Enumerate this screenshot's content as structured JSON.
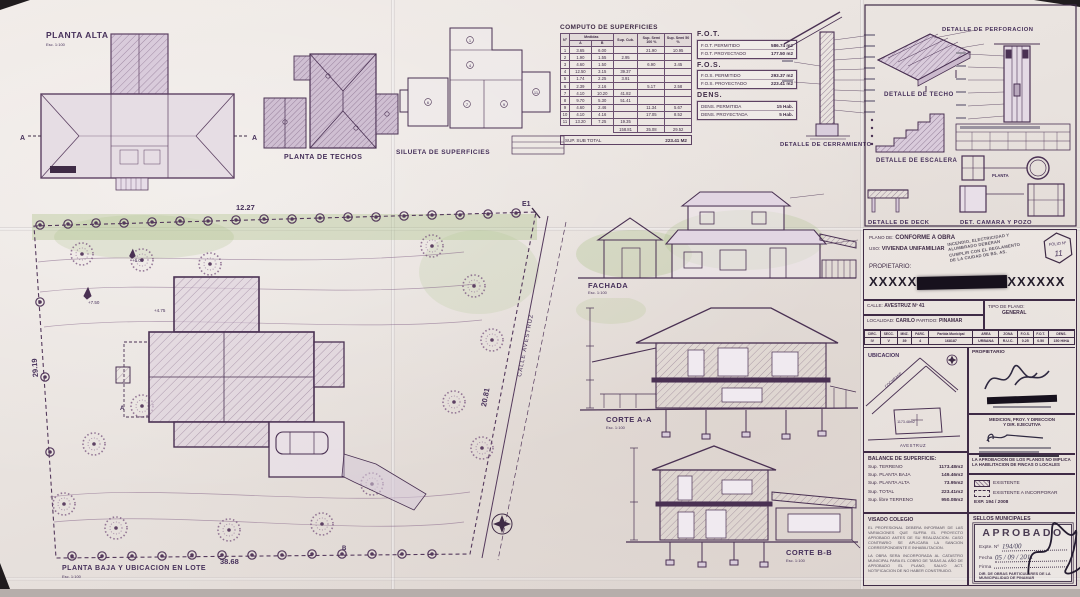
{
  "captions": {
    "planta_alta": "PLANTA ALTA",
    "planta_techos": "PLANTA DE TECHOS",
    "silueta": "SILUETA DE SUPERFICIES",
    "fachada": "FACHADA",
    "corte_aa": "CORTE A-A",
    "corte_bb": "CORTE B-B",
    "planta_baja": "PLANTA BAJA Y UBICACION EN LOTE",
    "det_cerramiento": "DETALLE DE CERRAMIENTO",
    "det_techo": "DETALLE DE TECHO",
    "det_perforacion": "DETALLE DE PERFORACION",
    "det_escalera": "DETALLE DE ESCALERA",
    "det_deck": "DETALLE DE DECK",
    "det_camara": "DET. CAMARA Y POZO",
    "planta_small": "PLANTA",
    "scale_100": "Esc. 1:100",
    "scale_200": "Esc. 1:200"
  },
  "site": {
    "dim_top": "12.27",
    "dim_left": "29.19",
    "dim_right": "20.81",
    "dim_bottom": "38.68",
    "street": "CALLE  AVESTRUZ",
    "marker_e1": "E1",
    "marker_a": "A",
    "marker_b": "B",
    "contour_1": "+6.00",
    "contour_2": "+7.50",
    "contour_3": "+4.75"
  },
  "silueta_tags": [
    "1",
    "4",
    "6",
    "7",
    "9",
    "11"
  ],
  "computo": {
    "title": "COMPUTO DE SUPERFICIES",
    "col_n": "Nº",
    "col_medidas": "Medidas",
    "col_a": "A",
    "col_b": "B",
    "col_cub": "Sup. Cub.",
    "col_semi100": "Sup. Semi 100 %",
    "col_semi50": "Sup. Semi 50 %",
    "rows": [
      [
        "1",
        "3.65",
        "6.00",
        "",
        "21.90",
        "10.95"
      ],
      [
        "2",
        "1.90",
        "1.55",
        "2.95",
        "",
        ""
      ],
      [
        "3",
        "4.60",
        "1.50",
        "",
        "6.90",
        "3.45"
      ],
      [
        "4",
        "12.50",
        "3.15",
        "39.37",
        "",
        ""
      ],
      [
        "5",
        "1.74",
        "2.25",
        "3.91",
        "",
        ""
      ],
      [
        "6",
        "2.39",
        "2.16",
        "",
        "5.17",
        "2.58"
      ],
      [
        "7",
        "4.10",
        "10.20",
        "41.82",
        "",
        ""
      ],
      [
        "8",
        "9.70",
        "5.30",
        "51.41",
        "",
        ""
      ],
      [
        "9",
        "4.60",
        "2.46",
        "",
        "11.34",
        "5.67"
      ],
      [
        "10",
        "4.10",
        "4.16",
        "",
        "17.05",
        "8.52"
      ],
      [
        "11",
        "13.20",
        "7.25",
        "19.35",
        "",
        ""
      ]
    ],
    "totals": [
      "158.81",
      "35.08",
      "29.52"
    ],
    "subtotal_label": "SUP. SUB TOTAL",
    "subtotal_value": "223.41  M2"
  },
  "indices": {
    "fot_title": "F.O.T.",
    "fot_rows": [
      [
        "F.O.T. PERMITIDO",
        "586.74 m2"
      ],
      [
        "F.O.T. PROYECTADO",
        "177.50 m2"
      ]
    ],
    "fos_title": "F.O.S.",
    "fos_rows": [
      [
        "F.O.S. PERMITIDO",
        "293.37 m2"
      ],
      [
        "F.O.S. PROYECTADO",
        "223.41 m2"
      ]
    ],
    "dens_title": "DENS.",
    "dens_rows": [
      [
        "DENS. PERMITIDA",
        "15 Hab."
      ],
      [
        "DENS. PROYECTADA",
        "5 Hab."
      ]
    ]
  },
  "titleblock": {
    "plano_label": "PLANO DE:",
    "plano_value": "CONFORME A OBRA",
    "uso_label": "USO:",
    "uso_value": "VIVIENDA UNIFAMILIAR",
    "stamp_lines": [
      "INCENDIO, ELECTRICIDAD Y",
      "ALUMBRADO DEBERAN",
      "CUMPLIR CON EL REGLAMENTO",
      "DE LA CIUDAD DE BS. AS."
    ],
    "folio_label": "FOLIO Nº",
    "folio_value": "11",
    "propietario_label": "PROPIETARIO:",
    "redacted_left": "XXXXX",
    "redacted_right": "XXXXXX",
    "calle_label": "CALLE:",
    "calle_value": "AVESTRUZ Nº 41",
    "tipo_label": "TIPO DE PLANO:",
    "tipo_value": "GENERAL",
    "localidad_label": "LOCALIDAD:",
    "localidad_value": "CARILO",
    "partido_label": "PARTIDO:",
    "partido_value": "PINAMAR",
    "parcel_headers": [
      "CIRC.",
      "SECC.",
      "MNZ.",
      "PARC.",
      "Partida Municipal",
      "AREA",
      "ZONA",
      "F.O.S.",
      "F.O.T.",
      "DENS."
    ],
    "parcel_values": [
      "IV",
      "V",
      "39",
      "4",
      "168187",
      "URBANA",
      "R.U.C.",
      "0.25",
      "0.50",
      "150 H/HA"
    ],
    "ubicacion_label": "UBICACION",
    "map_area": "1173.48m2",
    "map_street_1": "COCHRANE",
    "map_street_2": "AVESTRUZ",
    "prop_sign_label": "PROPIETARIO",
    "medicion_label_1": "MEDICION, PROY. Y DIRECCION",
    "medicion_label_2": "Y DIR. EJECUTIVA",
    "nota": "LA APROBACION DE LOS PLANOS NO IMPLICA LA HABILITACION DE FINCAS O LOCALES",
    "legend_existente": "EXISTENTE",
    "legend_incorporar": "EXISTENTE A INCORPORAR",
    "exp": "EXP. 194 / 2008",
    "balance_title": "BALANCE DE SUPERFICIE:",
    "balance_rows": [
      [
        "Sup. TERRENO",
        "1173.48m2"
      ],
      [
        "Sup. PLANTA BAJA",
        "149.46m2"
      ],
      [
        "Sup. PLANTA ALTA",
        "73.95m2"
      ],
      [
        "Sup. TOTAL",
        "223.41m2"
      ],
      [
        "Sup. libre TERRENO",
        "950.08m2"
      ]
    ],
    "visado_title": "VISADO COLEGIO",
    "visado_p1": "EL PROFESIONAL DEBERA INFORMAR DE LAS VARIACIONES QUE SUFRA EL PROYECTO APROBADO ANTES DE SU REALIZACION. CASO CONTRARIO SE APLICARA LA SANCION CORRESPONDIENTE E INHABILITACION.",
    "visado_p2": "LA OBRA SERA INCORPORADA AL CATASTRO MUNICIPAL PARA EL COBRO DE TASAS AL AÑO DE APROBADO EL PLANO, SALVO ACT. NOTIFICACION DE NO HABER CONSTRUIDO.",
    "sellos_title": "SELLOS MUNICIPALES",
    "aprobado": "APROBADO",
    "expte_label": "Expte. Nº",
    "expte_value": "194/00",
    "fecha_label": "Fecha",
    "fecha_value": "05 / 09 / 2011",
    "firma_label": "Firma",
    "dir_line": "DIR. DE OBRAS PARTICULARES DE LA MUNICIPALIDAD DE PINAMAR"
  }
}
